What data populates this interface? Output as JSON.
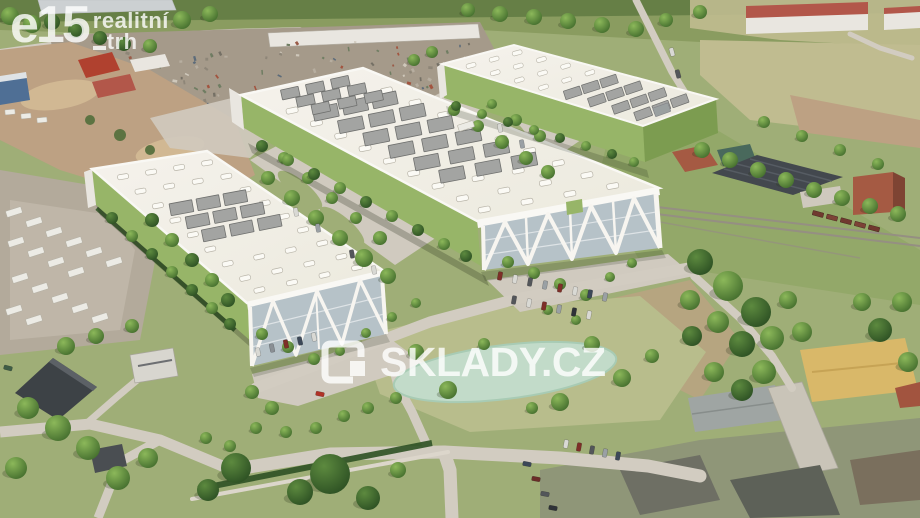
{
  "watermarks": {
    "e15_logo": {
      "main": "e15",
      "sub_top": "realitní",
      "sub_bottom": "trh"
    },
    "sklady_logo": {
      "text": "SKLADY.CZ"
    }
  },
  "icons": {
    "sklady_icon": "warehouse-box-icon"
  },
  "palette": {
    "grass": "#9fae77",
    "grassDry": "#b8bd8c",
    "hill": "#8a9c60",
    "hillTrees": "#5f7a42",
    "khaki": "#c0bc90",
    "dirt": "#bda183",
    "dirtLight": "#d1b893",
    "scrap": "#a59a8a",
    "yard": "#b3aa9b",
    "yardLight": "#c6beb0",
    "paving": "#d0cabf",
    "road": "#d2ccc1",
    "roadLight": "#dcd6cb",
    "roofWhite": "#f2efe7",
    "fascia": "#f9f8f4",
    "greenWall": "#97b568",
    "greenWallDark": "#7c9c50",
    "glass": "#b6c2c8",
    "truss": "#f7f5f0",
    "solar": "#a3a4a2",
    "solarDark": "#6f706e",
    "skylight": "#fbfaf5",
    "pond": "#c2dbc9",
    "pondEdge": "#a8cbb4",
    "redRoof": "#b2574a",
    "brick": "#a55a43",
    "brickDark": "#7e4433",
    "darkHall": "#43484e",
    "darkBld": "#3d4246",
    "whiteBld": "#e9e6e0",
    "tanRoof": "#d9b869",
    "tanRidge": "#c6a355",
    "grayRoof": "#9fa5a3",
    "rail": "#958f82",
    "treeLight": "#86b355",
    "treeDark": "#46702f",
    "treeDeep": "#2e5224"
  }
}
